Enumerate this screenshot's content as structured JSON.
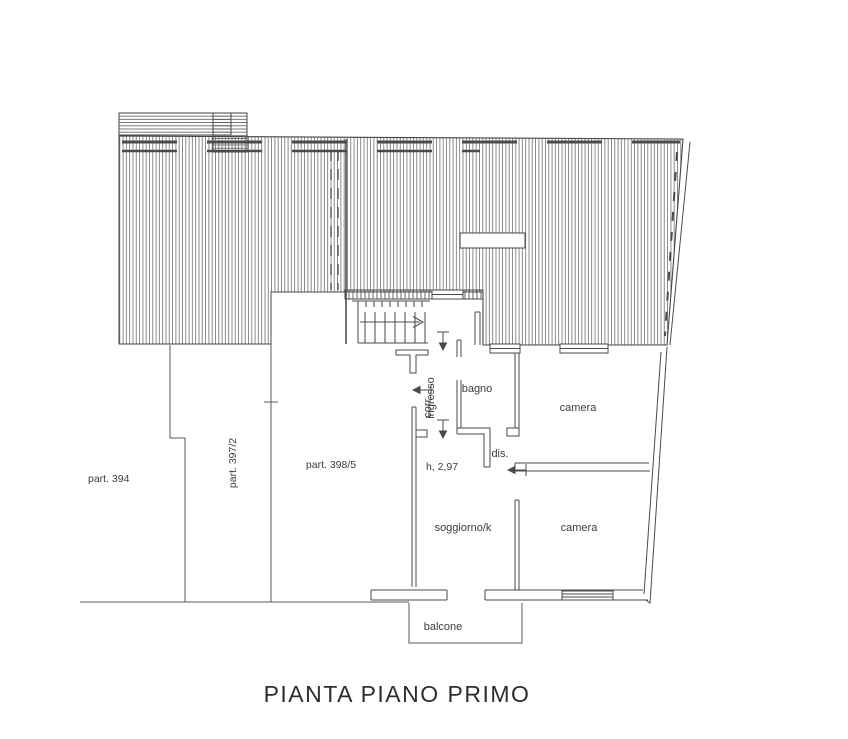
{
  "page": {
    "title": "PIANTA PIANO PRIMO"
  },
  "parcels": {
    "p394": "part. 394",
    "p397": "part. 397/2",
    "p398": "part. 398/5"
  },
  "rooms": {
    "ingresso": "ingresso",
    "corridoio": "corr.",
    "bagno": "bagno",
    "camera_top": "camera",
    "camera_bottom": "camera",
    "dis": "dis.",
    "soggiorno": "soggiorno/k",
    "balcone": "balcone"
  },
  "annotations": {
    "height": "h, 2,97"
  },
  "colors": {
    "line": "#4a4a4a",
    "hatch": "#6e6e6e",
    "text": "#3c3c3c"
  }
}
